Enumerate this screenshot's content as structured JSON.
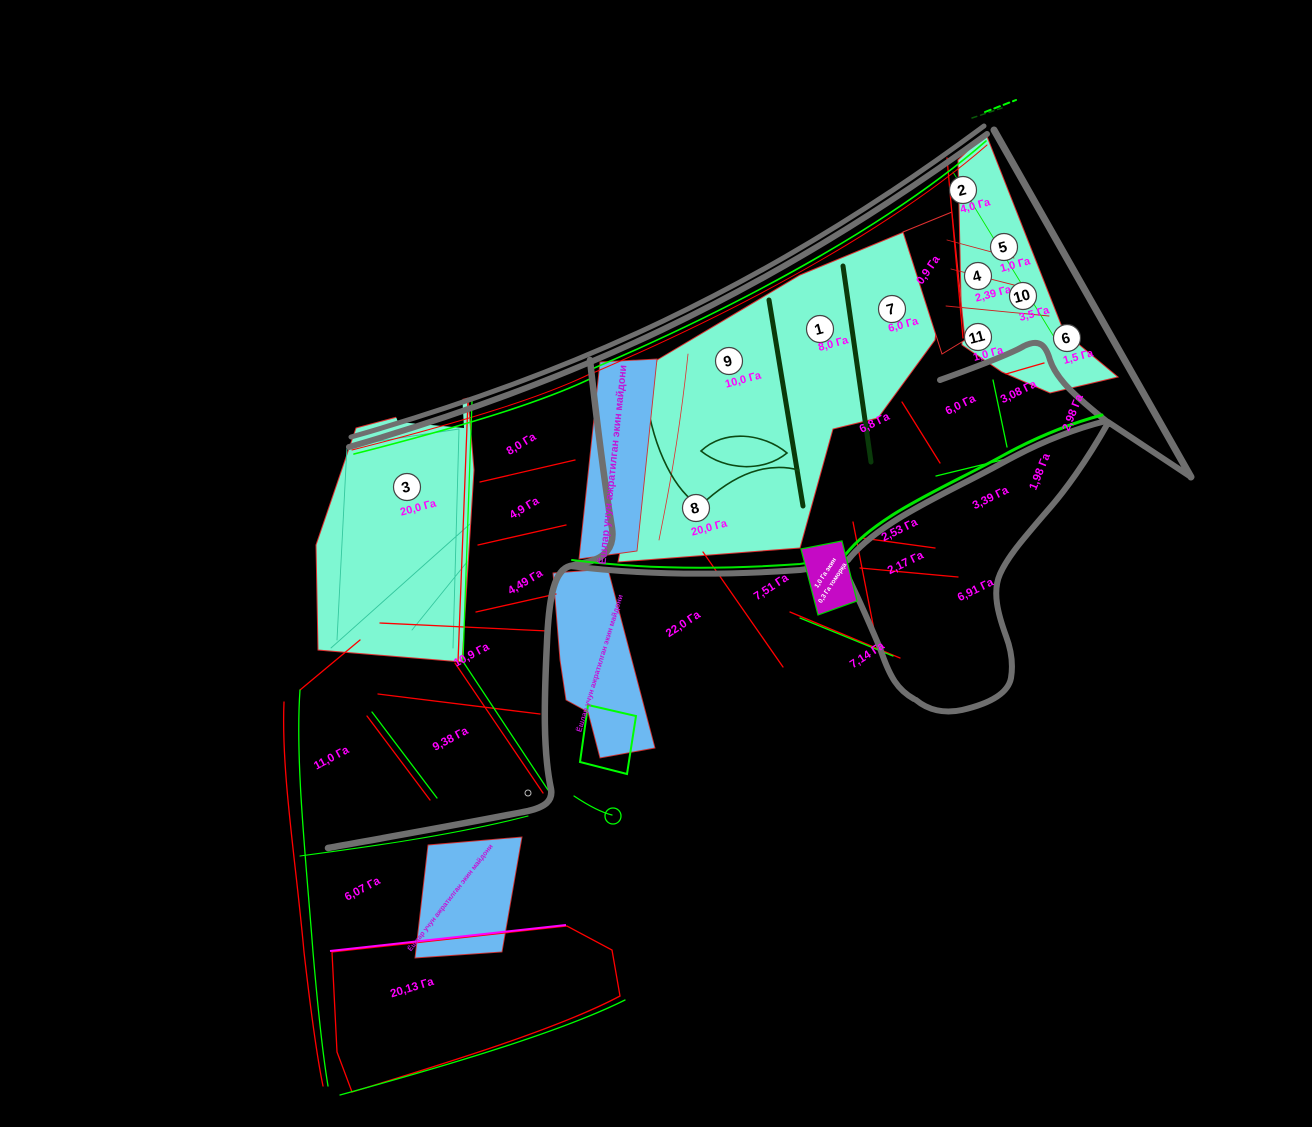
{
  "map": {
    "colors": {
      "background": "#000000",
      "parcel_fill": "#7ef7d2",
      "water_fill": "#6db9f2",
      "road": "#6f6f6f",
      "boundary_red": "#ff0000",
      "boundary_green": "#00ff00",
      "label_magenta": "#ff00ff",
      "mixed_parcel_fill": "#c50ac5"
    },
    "badges": [
      {
        "n": "1",
        "x": 820,
        "y": 329,
        "area": "8,0 Га",
        "ax": 834,
        "ay": 343
      },
      {
        "n": "2",
        "x": 963,
        "y": 190,
        "area": "4,0 Га",
        "ax": 976,
        "ay": 205
      },
      {
        "n": "3",
        "x": 407,
        "y": 487,
        "area": "20,0 Га",
        "ax": 419,
        "ay": 507
      },
      {
        "n": "4",
        "x": 978,
        "y": 276,
        "area": "2,39 Га",
        "ax": 994,
        "ay": 293
      },
      {
        "n": "5",
        "x": 1004,
        "y": 247,
        "area": "1,0 Га",
        "ax": 1016,
        "ay": 264
      },
      {
        "n": "6",
        "x": 1067,
        "y": 338,
        "area": "1,5 Га",
        "ax": 1079,
        "ay": 356
      },
      {
        "n": "7",
        "x": 892,
        "y": 309,
        "area": "6,0 Га",
        "ax": 904,
        "ay": 324
      },
      {
        "n": "8",
        "x": 696,
        "y": 508,
        "area": "20,0 Га",
        "ax": 710,
        "ay": 527
      },
      {
        "n": "9",
        "x": 729,
        "y": 361,
        "area": "10,0 Га",
        "ax": 744,
        "ay": 379
      },
      {
        "n": "10",
        "x": 1023,
        "y": 296,
        "area": "3,5 Га",
        "ax": 1035,
        "ay": 313
      },
      {
        "n": "11",
        "x": 978,
        "y": 337,
        "area": "1,0 Га",
        "ax": 989,
        "ay": 353
      }
    ],
    "area_labels": [
      {
        "t": "8,0 Га",
        "x": 523,
        "y": 447,
        "r": -31
      },
      {
        "t": "4,9 Га",
        "x": 526,
        "y": 511,
        "r": -31
      },
      {
        "t": "4,49 Га",
        "x": 527,
        "y": 585,
        "r": -31
      },
      {
        "t": "10,9 Га",
        "x": 473,
        "y": 658,
        "r": -28
      },
      {
        "t": "9,38 Га",
        "x": 452,
        "y": 742,
        "r": -28
      },
      {
        "t": "11,0 Га",
        "x": 333,
        "y": 761,
        "r": -28
      },
      {
        "t": "6,07 Га",
        "x": 364,
        "y": 892,
        "r": -28
      },
      {
        "t": "20,13 Га",
        "x": 413,
        "y": 991,
        "r": -17
      },
      {
        "t": "22,0 Га",
        "x": 685,
        "y": 627,
        "r": -33
      },
      {
        "t": "7,51 Га",
        "x": 773,
        "y": 590,
        "r": -33
      },
      {
        "t": "7,14 Га",
        "x": 869,
        "y": 658,
        "r": -33
      },
      {
        "t": "6,8 Га",
        "x": 876,
        "y": 426,
        "r": -26
      },
      {
        "t": "6,0 Га",
        "x": 962,
        "y": 408,
        "r": -26
      },
      {
        "t": "3,08 Га",
        "x": 1020,
        "y": 395,
        "r": -26
      },
      {
        "t": "2,98 Га",
        "x": 1076,
        "y": 414,
        "r": -68
      },
      {
        "t": "1,98 Га",
        "x": 1043,
        "y": 473,
        "r": -68
      },
      {
        "t": "3,39 Га",
        "x": 992,
        "y": 501,
        "r": -26
      },
      {
        "t": "2,53 Га",
        "x": 901,
        "y": 533,
        "r": -26
      },
      {
        "t": "2,17 Га",
        "x": 907,
        "y": 566,
        "r": -26
      },
      {
        "t": "6,91 Га",
        "x": 977,
        "y": 593,
        "r": -26
      },
      {
        "t": "0,9 Га",
        "x": 931,
        "y": 272,
        "r": -55
      }
    ],
    "strip_labels": [
      {
        "t": "Ёшлар учун ажратилган экин майдони",
        "x": 616,
        "y": 465,
        "r": -84,
        "s": 10.5
      },
      {
        "t": "Ёшлар учун ажратилган экин майдони",
        "x": 602,
        "y": 664,
        "r": -73,
        "s": 7.5
      },
      {
        "t": "Ёшлар учун ажратилган экин майдони",
        "x": 452,
        "y": 899,
        "r": -52,
        "s": 7
      }
    ],
    "mixed_parcel_label": {
      "line1": "1,0 Га экин",
      "line2": "0,3 Га томорқа",
      "x": 827,
      "y": 574,
      "r": -57
    }
  }
}
